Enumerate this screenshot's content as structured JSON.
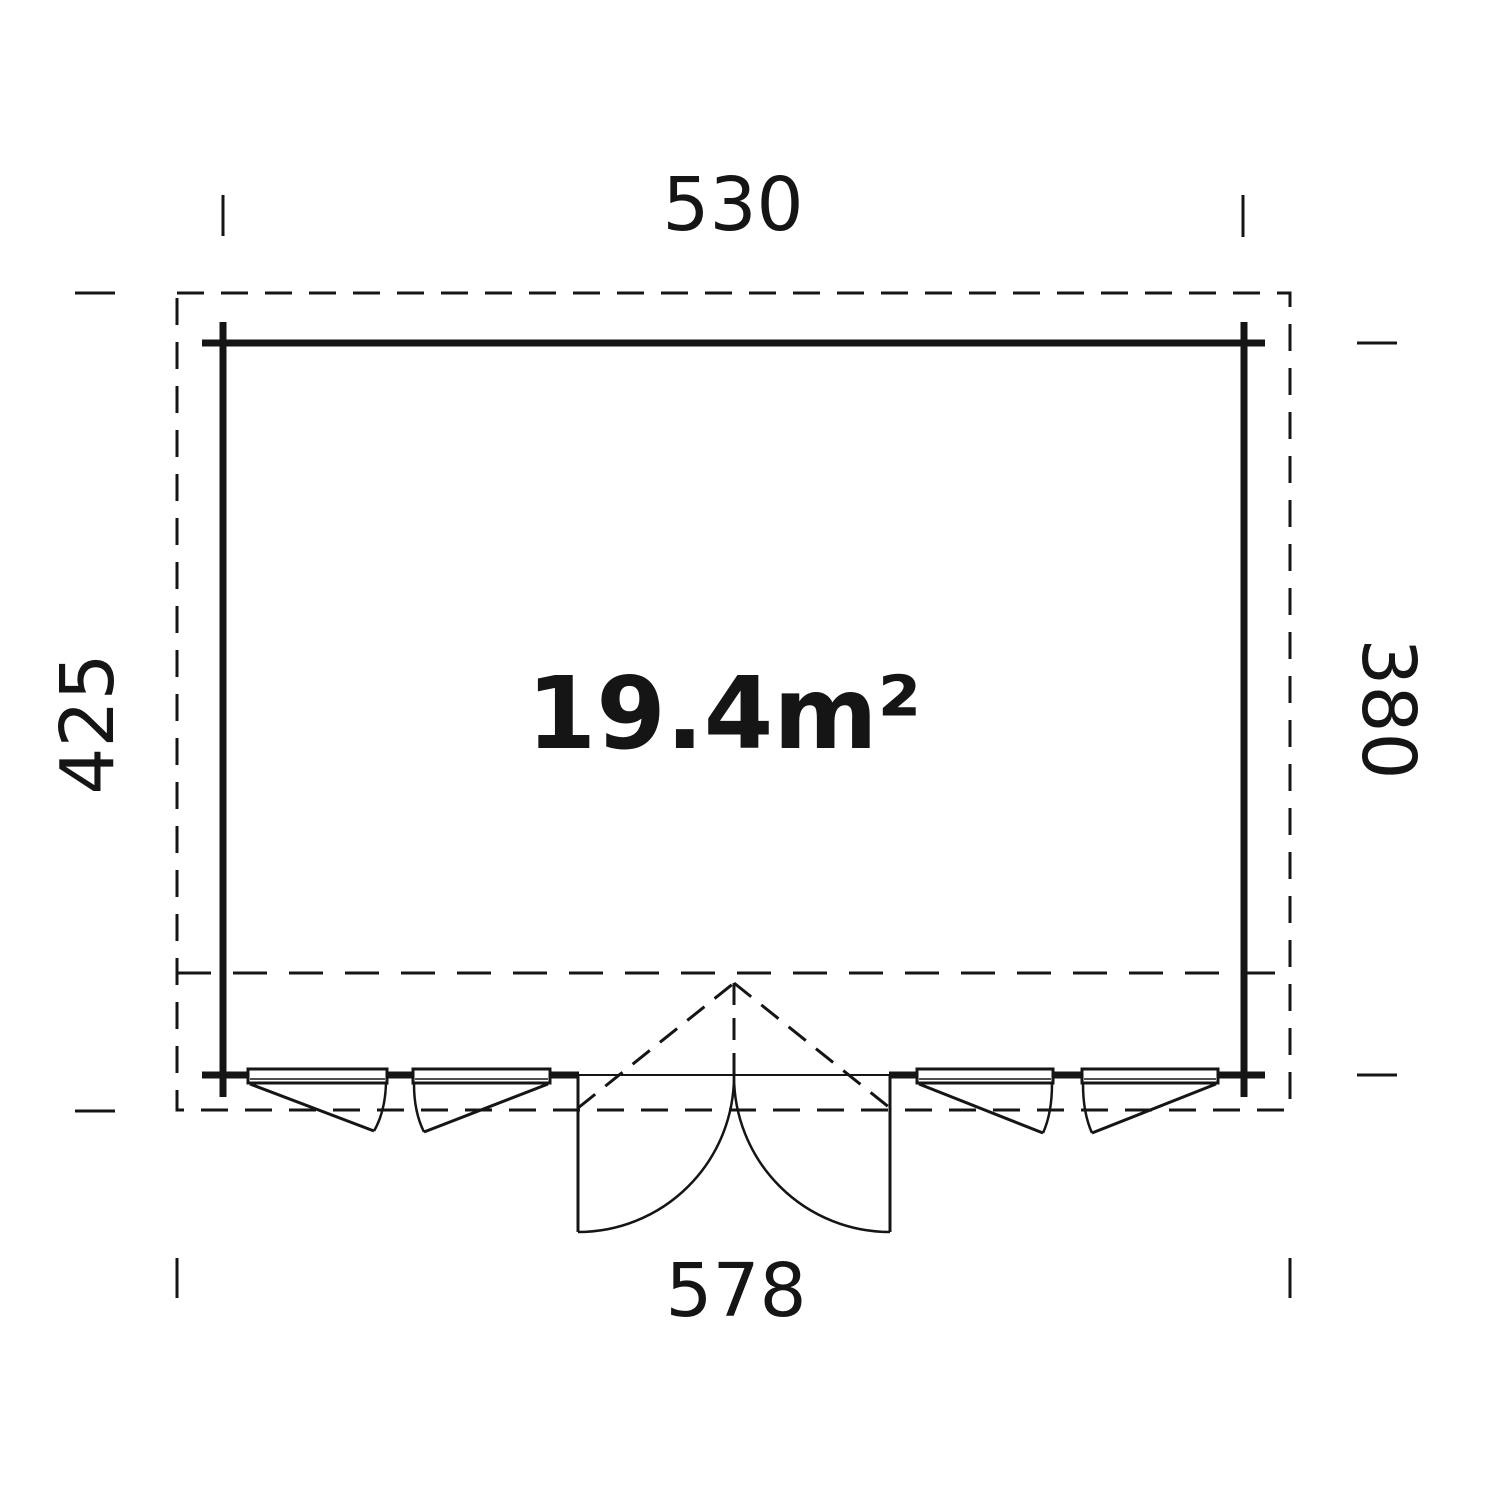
{
  "plan": {
    "area_label": "19.4m²",
    "dimensions": {
      "top": "530",
      "bottom": "578",
      "left": "425",
      "right": "380"
    },
    "features": {
      "window_count": 4,
      "door": "double door, outward opening",
      "outline": "dashed roof-overhang outline around solid walls"
    },
    "colors": {
      "line": "#151515",
      "background": "#ffffff"
    }
  }
}
